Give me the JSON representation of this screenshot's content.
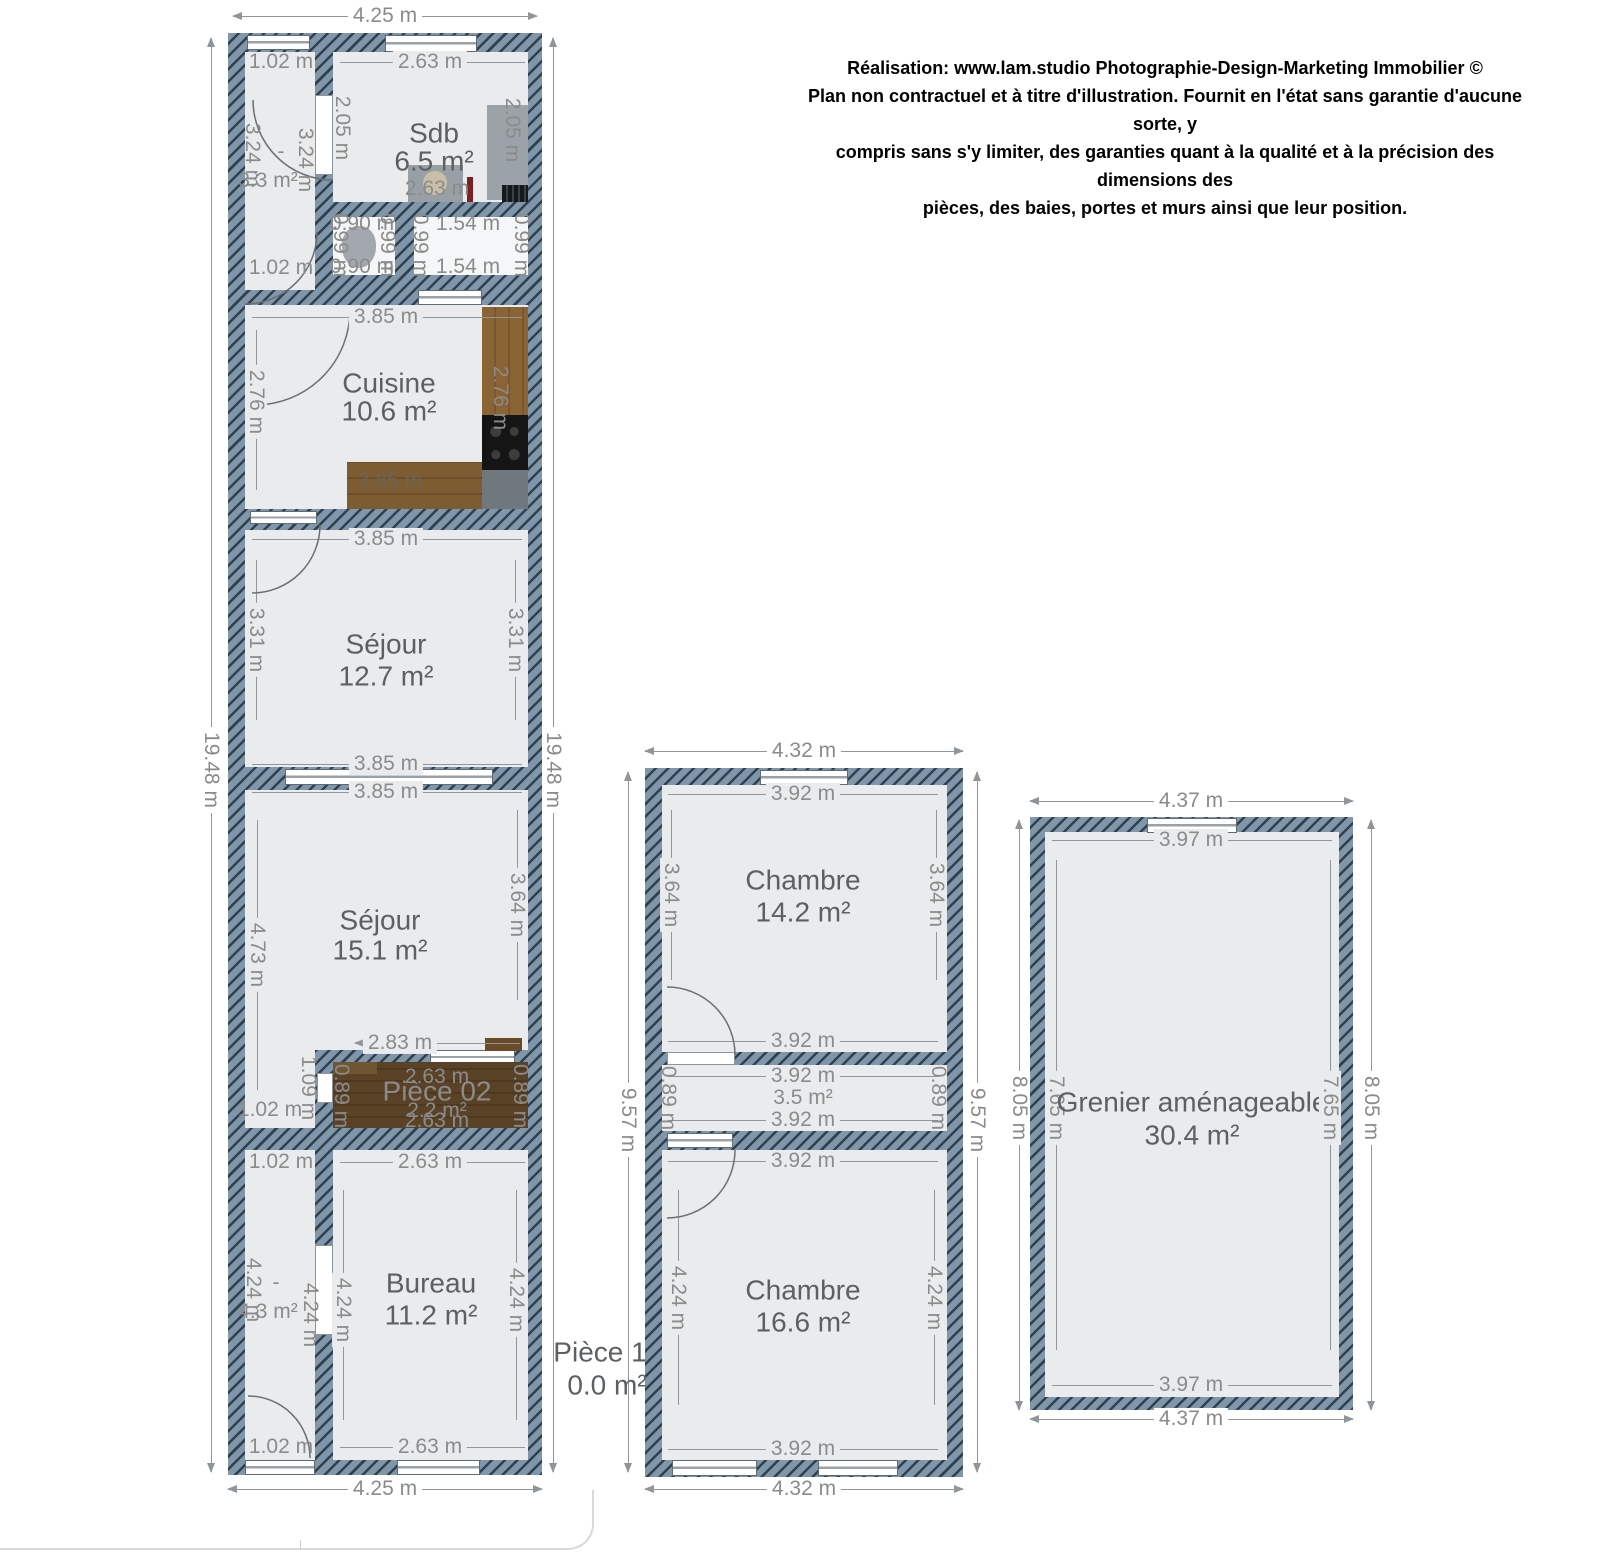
{
  "disclaimer": {
    "line1": "Réalisation: www.lam.studio Photographie-Design-Marketing Immobilier ©",
    "line2": "Plan non contractuel et à titre d'illustration. Fournit en l'état sans garantie d'aucune sorte, y",
    "line3": "compris sans s'y limiter, des garanties quant à la qualité et à la précision des dimensions des",
    "line4": "pièces, des baies, portes et murs ainsi que leur position."
  },
  "lb": {
    "top": "4.25 m",
    "bottom": "4.25 m",
    "left": "19.48 m",
    "right": "19.48 m",
    "hall1": {
      "dash": "-",
      "area": "3.3 m²",
      "w1": "1.02 m",
      "w2": "1.02 m",
      "h1": "3.24 m",
      "h2": "3.24 m"
    },
    "sdb": {
      "name": "Sdb",
      "area": "6.5 m²",
      "t": "2.63 m",
      "b": "2.63 m",
      "l": "2.05 m",
      "r": "2.05 m"
    },
    "wc": {
      "t": "0.90 m",
      "b": "0.90 m",
      "l": "0.99 m",
      "r": "0.99 m"
    },
    "st": {
      "t": "1.54 m",
      "b": "1.54 m",
      "l": "0.99 m",
      "r": "0.99 m"
    },
    "cuisine": {
      "name": "Cuisine",
      "area": "10.6 m²",
      "t": "3.85 m",
      "b": "3.85 m",
      "l": "2.76 m",
      "r": "2.76 m"
    },
    "sejour1": {
      "name": "Séjour",
      "area": "12.7 m²",
      "t": "3.85 m",
      "b": "3.85 m",
      "l": "3.31 m",
      "r": "3.31 m"
    },
    "sejour2": {
      "name": "Séjour",
      "area": "15.1 m²",
      "t": "3.85 m",
      "bp": "2.83 m",
      "l": "4.73 m",
      "r": "3.64 m"
    },
    "p02": {
      "name": "Pièce 02",
      "area": "2.2 m²",
      "t": "2.63 m",
      "b": "2.63 m",
      "l": "0.89 m",
      "r": "0.89 m",
      "lo": "1.09 m",
      "hw": "1.02 m"
    },
    "hall2": {
      "dash": "-",
      "area": "4.3 m²",
      "w1": "1.02 m",
      "w2": "1.02 m",
      "h1": "4.24 m",
      "h2": "4.24 m"
    },
    "bureau": {
      "name": "Bureau",
      "area": "11.2 m²",
      "t": "2.63 m",
      "b": "2.63 m",
      "l": "4.24 m",
      "r": "4.24 m"
    }
  },
  "mb": {
    "top": "4.32 m",
    "bottom": "4.32 m",
    "left": "9.57 m",
    "right": "9.57 m",
    "ch1": {
      "name": "Chambre",
      "area": "14.2 m²",
      "t": "3.92 m",
      "b": "3.92 m",
      "l": "3.64 m",
      "r": "3.64 m"
    },
    "sr": {
      "area": "3.5 m²",
      "t": "3.92 m",
      "b": "3.92 m",
      "l": "0.89 m",
      "r": "0.89 m"
    },
    "ch2": {
      "name": "Chambre",
      "area": "16.6 m²",
      "t": "3.92 m",
      "b": "3.92 m",
      "l": "4.24 m",
      "r": "4.24 m"
    },
    "p1": {
      "name": "Pièce 1",
      "area": "0.0 m²"
    }
  },
  "rb": {
    "name": "Grenier aménageable",
    "area": "30.4 m²",
    "top": "4.37 m",
    "bottom": "4.37 m",
    "left": "8.05 m",
    "right": "8.05 m",
    "it": "3.97 m",
    "ib": "3.97 m",
    "il": "7.65 m",
    "ir": "7.65 m"
  },
  "colors": {
    "wall_base": "#8096aa",
    "wall_stripe": "#31404e",
    "room_fill": "#e9ebed",
    "dim_text": "#8b8b8b"
  }
}
